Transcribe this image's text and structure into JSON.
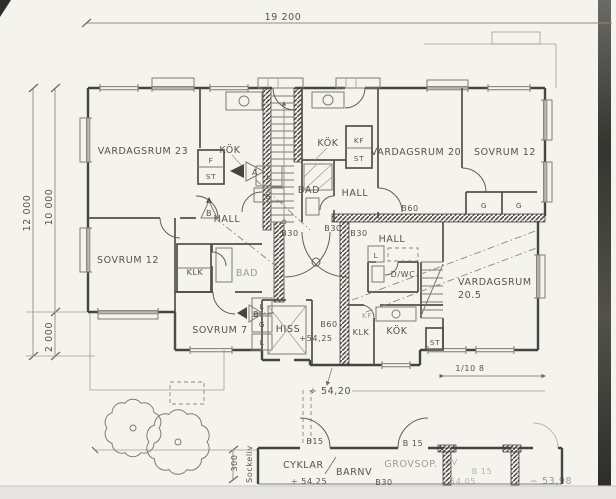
{
  "dims": {
    "total_width": "19 200",
    "total_height": "12 000",
    "main_depth": "10 000",
    "terrace_depth": "2 000",
    "stair_note": "1/10 8",
    "plinth_offset": "300",
    "plinth_word": "Sockeliv"
  },
  "levels": {
    "landing": "+54,25",
    "yard": "÷ 54,20",
    "outbuilding": "÷ 54,25",
    "outbuilding_right": "54,05",
    "ground_right": "− 53,98"
  },
  "apt_left": {
    "living": "VARDAGSRUM 23",
    "kitchen": "KÖK",
    "fridge": "F",
    "pantry": "ST",
    "cooler": "K",
    "wardrobe": "G",
    "hall": "HALL",
    "bedroom": "SOVRUM 12",
    "closet": "KLK",
    "bath": "BAD",
    "bedroom2": "SOVRUM 7",
    "linen1": "L",
    "wardrobe2": "G",
    "linen2": "L"
  },
  "apt_mid": {
    "kitchen": "KÖK",
    "fridge_freezer": "KF",
    "pantry": "ST",
    "bath": "BAD",
    "hall": "HALL",
    "living": "VARDAGSRUM 20",
    "bedroom": "SOVRUM 12",
    "wardrobe1": "G",
    "wardrobe2": "G"
  },
  "apt_right": {
    "hall": "HALL",
    "linen": "L",
    "wc": "D/WC",
    "living1": "VARDAGSRUM",
    "living2": "20.5",
    "closet": "KLK",
    "kitchen": "KÖK",
    "fridge_freezer": "KF",
    "pantry": "ST"
  },
  "core": {
    "lift": "HISS",
    "wall": "B60"
  },
  "fire": {
    "b60": "B60",
    "b30_1": "B30",
    "b30_2": "B30",
    "b30_3": "B30"
  },
  "out": {
    "door1": "B15",
    "door2": "B 15",
    "door3": "B 15",
    "bikes": "CYKLAR",
    "prams": "BARNV",
    "waste": "GROVSOP.",
    "waste2": "AV",
    "door_b30": "B30"
  },
  "markers": {
    "a": "A",
    "b1": "B",
    "b2": "B"
  }
}
